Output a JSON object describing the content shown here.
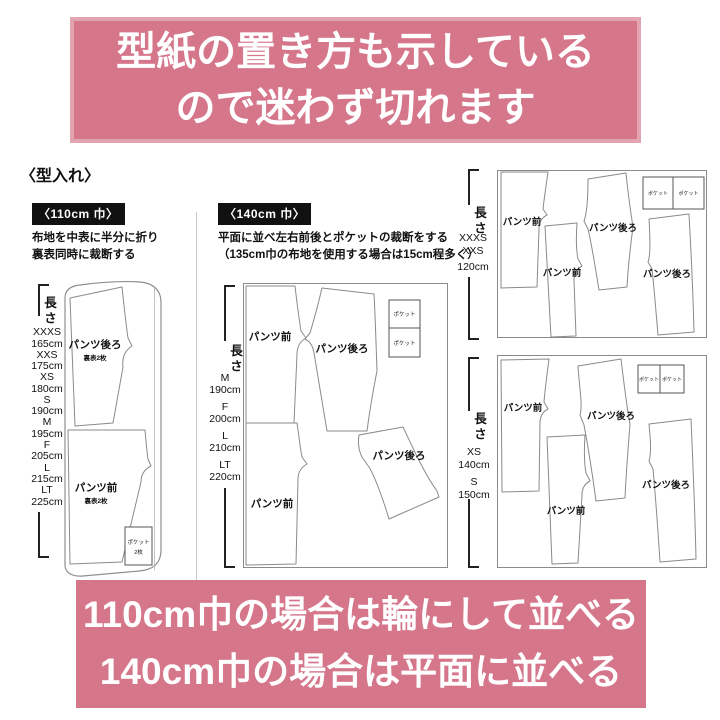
{
  "banner_top": {
    "line1": "型紙の置き方も示している",
    "line2": "ので迷わず切れます"
  },
  "section_title": "〈型入れ〉",
  "panel_110": {
    "width_tag": "〈110cm 巾〉",
    "instruction_line1": "布地を中表に半分に折り",
    "instruction_line2": "裏表同時に裁断する",
    "length_label": "長さ",
    "sizes": [
      {
        "size": "XXXS",
        "length": "165cm"
      },
      {
        "size": "XXS",
        "length": "175cm"
      },
      {
        "size": "XS",
        "length": "180cm"
      },
      {
        "size": "S",
        "length": "190cm"
      },
      {
        "size": "M",
        "length": "195cm"
      },
      {
        "size": "F",
        "length": "205cm"
      },
      {
        "size": "L",
        "length": "215cm"
      },
      {
        "size": "LT",
        "length": "225cm"
      }
    ],
    "piece_back": "パンツ後ろ",
    "piece_back_sub": "裏表2枚",
    "piece_front": "パンツ前",
    "piece_front_sub": "裏表2枚",
    "pocket": "ポケット",
    "pocket_sub": "2枚"
  },
  "panel_140": {
    "width_tag": "〈140cm 巾〉",
    "instruction_line1": "平面に並べ左右前後とポケットの裁断をする",
    "instruction_line2": "（135cm巾の布地を使用する場合は15cm程多く）",
    "length_label": "長さ",
    "sizes": [
      {
        "size": "M",
        "length": "190cm"
      },
      {
        "size": "F",
        "length": "200cm"
      },
      {
        "size": "L",
        "length": "210cm"
      },
      {
        "size": "LT",
        "length": "220cm"
      }
    ],
    "piece_front_top": "パンツ前",
    "piece_back_top": "パンツ後ろ",
    "piece_front_bottom": "パンツ前",
    "piece_back_bottom": "パンツ後ろ",
    "pocket1": "ポケット",
    "pocket2": "ポケット"
  },
  "panel_right_top": {
    "length_label": "長さ",
    "size_line1": "XXXS",
    "size_line2": "XXS",
    "size_line3": "120cm",
    "piece_front1": "パンツ前",
    "piece_front2": "パンツ前",
    "piece_back1": "パンツ後ろ",
    "piece_back2": "パンツ後ろ",
    "pocket1": "ポケット",
    "pocket2": "ポケット"
  },
  "panel_right_bottom": {
    "length_label": "長さ",
    "sizes": [
      {
        "size": "XS",
        "length": "140cm"
      },
      {
        "size": "S",
        "length": "150cm"
      }
    ],
    "piece_front1": "パンツ前",
    "piece_front2": "パンツ前",
    "piece_back1": "パンツ後ろ",
    "piece_back2": "パンツ後ろ",
    "pocket1": "ポケット",
    "pocket2": "ポケット"
  },
  "banner_bottom": {
    "line1": "110cm巾の場合は輪にして並べる",
    "line2": "140cm巾の場合は平面に並べる"
  },
  "colors": {
    "banner_pink": "#d5768b",
    "tag_black": "#111111",
    "diagram_line": "#8a8a8a"
  }
}
